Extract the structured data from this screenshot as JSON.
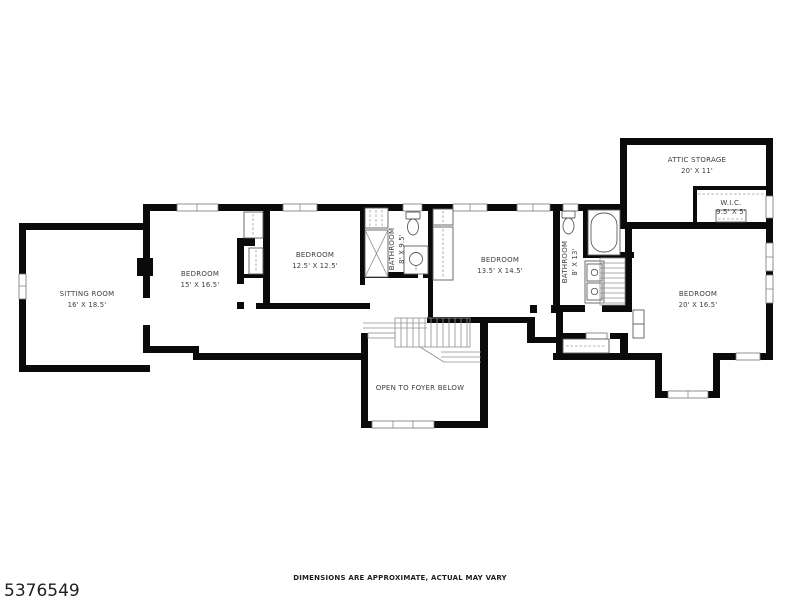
{
  "image_type": "real-estate floor plan",
  "footer": {
    "mls_number": "5376549",
    "disclaimer": "DIMENSIONS ARE APPROXIMATE, ACTUAL MAY VARY"
  },
  "rooms": [
    {
      "id": "sitting-room",
      "name": "SITTING ROOM",
      "dims": "16' X 18.5'"
    },
    {
      "id": "bedroom-1",
      "name": "BEDROOM",
      "dims": "15' X 16.5'"
    },
    {
      "id": "bedroom-2",
      "name": "BEDROOM",
      "dims": "12.5' X 12.5'"
    },
    {
      "id": "bathroom-1",
      "name": "BATHROOM",
      "dims": "8' X 9.5'"
    },
    {
      "id": "bedroom-3",
      "name": "BEDROOM",
      "dims": "13.5' X 14.5'"
    },
    {
      "id": "bathroom-2",
      "name": "BATHROOM",
      "dims": "8' X 13'"
    },
    {
      "id": "attic-storage",
      "name": "ATTIC STORAGE",
      "dims": "20' X 11'"
    },
    {
      "id": "wic",
      "name": "W.I.C.",
      "dims": "9.5' X 5'"
    },
    {
      "id": "bedroom-4",
      "name": "BEDROOM",
      "dims": "20' X 16.5'"
    },
    {
      "id": "foyer",
      "name": "OPEN TO FOYER BELOW",
      "dims": ""
    }
  ],
  "fixtures": [
    "shower",
    "toilet",
    "sink-vanity",
    "bathtub",
    "double-vanity",
    "closets",
    "stairs"
  ],
  "colors": {
    "background": "#ffffff",
    "wall": "#0a0a0a",
    "thin_line": "#8f8f8f",
    "label_text": "#3d3d3d",
    "footer_text": "#1f1f1f"
  }
}
